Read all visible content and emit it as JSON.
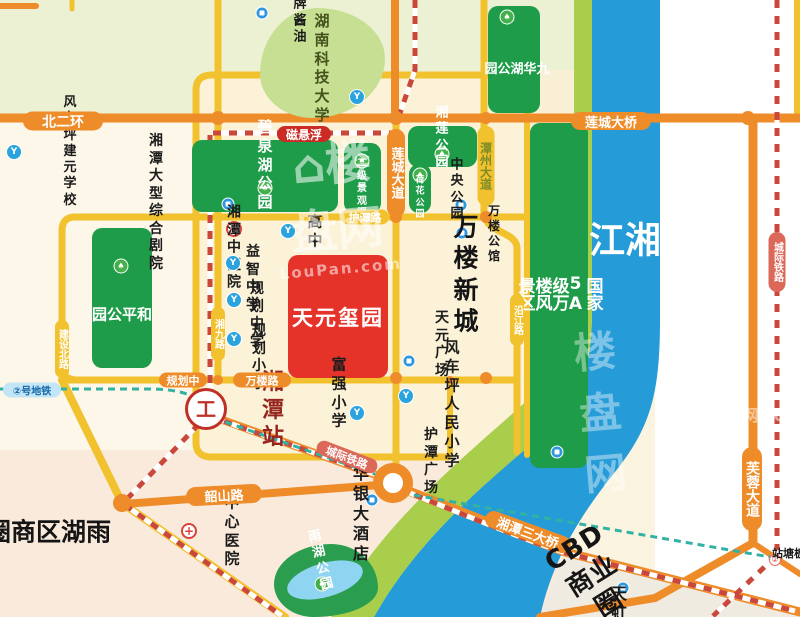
{
  "project": {
    "name_label": "天元玺园",
    "box": [
      288,
      255,
      100,
      123
    ],
    "color": "#E6332A"
  },
  "area_labels": [
    {
      "name": "wanlou-newtown-label",
      "text": "万楼新城",
      "c": [
        467,
        274
      ],
      "size": 25,
      "color": "#151515",
      "v": false,
      "rot": 0,
      "ls": 2
    },
    {
      "name": "yuhu-district-label",
      "text": "雨湖区商圈",
      "c": [
        47,
        532
      ],
      "size": 25,
      "color": "#151515",
      "v": true,
      "rot": 0,
      "ls": 2
    },
    {
      "name": "cbd-circle-label",
      "text": "CBD商业圈",
      "c": [
        592,
        576
      ],
      "size": 26,
      "color": "#151515",
      "v": false,
      "rot": -32,
      "ls": 1
    },
    {
      "name": "xiangjiang-river-label",
      "text": "湘江",
      "c": [
        621,
        241
      ],
      "size": 36,
      "color": "#FFFFFF",
      "v": true,
      "rot": 0,
      "ls": 4
    }
  ],
  "road_labels": [
    {
      "name": "beierhuan-road-label",
      "text": "北二环",
      "c": [
        63,
        121
      ],
      "w": 80,
      "h": 19,
      "bg": "#EE8C2A",
      "fg": "#FFFFFF",
      "size": 14,
      "v": false,
      "rot": 0
    },
    {
      "name": "liancheng-bridge-label",
      "text": "莲城大桥",
      "c": [
        611,
        121
      ],
      "w": 80,
      "h": 18,
      "bg": "#EE8C2A",
      "fg": "#FFFFFF",
      "size": 13,
      "v": false,
      "rot": 0
    },
    {
      "name": "maglev-label",
      "text": "磁悬浮",
      "c": [
        304,
        134
      ],
      "w": 54,
      "h": 16,
      "bg": "#CB2B24",
      "fg": "#FFFFFF",
      "size": 12,
      "v": false,
      "rot": 0
    },
    {
      "name": "liancheng-avenue-label",
      "text": "莲城大道",
      "c": [
        396,
        173
      ],
      "w": 18,
      "h": 88,
      "bg": "#EE8C2A",
      "fg": "#FFFFFF",
      "size": 13,
      "v": true,
      "rot": 0
    },
    {
      "name": "tanzhou-avenue-label",
      "text": "潭州大道",
      "c": [
        486,
        166
      ],
      "w": 17,
      "h": 80,
      "bg": "#F2C12E",
      "fg": "#7E8C28",
      "size": 12,
      "v": true,
      "rot": 0
    },
    {
      "name": "hutan-road-label",
      "text": "护潭路",
      "c": [
        365,
        217
      ],
      "w": 48,
      "h": 15,
      "bg": "#F2C12E",
      "fg": "#FFFFFF",
      "size": 11,
      "v": false,
      "rot": 0
    },
    {
      "name": "xiangjiu-road-label",
      "text": "湘九路",
      "c": [
        218,
        334
      ],
      "w": 14,
      "h": 54,
      "bg": "#F2C12E",
      "fg": "#FFFFFF",
      "size": 10,
      "v": true,
      "rot": 0
    },
    {
      "name": "jianshe-north-road-label",
      "text": "建设北路",
      "c": [
        62,
        349
      ],
      "w": 14,
      "h": 58,
      "bg": "#F2C12E",
      "fg": "#FFFFFF",
      "size": 10,
      "v": true,
      "rot": 0
    },
    {
      "name": "yanjiang-road-label",
      "text": "沿江路",
      "c": [
        517,
        320
      ],
      "w": 14,
      "h": 52,
      "bg": "#F2C12E",
      "fg": "#FFFFFF",
      "size": 10,
      "v": true,
      "rot": 0
    },
    {
      "name": "guihuazhong-road-label",
      "text": "规划中",
      "c": [
        183,
        380
      ],
      "w": 48,
      "h": 15,
      "bg": "#EE8C2A",
      "fg": "#FFFFFF",
      "size": 11,
      "v": false,
      "rot": 0
    },
    {
      "name": "wanlou-road-label",
      "text": "万楼路",
      "c": [
        262,
        380
      ],
      "w": 58,
      "h": 15,
      "bg": "#EE8C2A",
      "fg": "#FFFFFF",
      "size": 11,
      "v": false,
      "rot": 0
    },
    {
      "name": "shaoshan-road-label",
      "text": "韶山路",
      "c": [
        224,
        495
      ],
      "w": 76,
      "h": 19,
      "bg": "#EE8C2A",
      "fg": "#FFFFFF",
      "size": 13,
      "v": false,
      "rot": -3
    },
    {
      "name": "intercity-rail-sw-label",
      "text": "城际铁路",
      "c": [
        347,
        457
      ],
      "w": 64,
      "h": 15,
      "bg": "#DC685A",
      "fg": "#FFFFFF",
      "size": 11,
      "v": false,
      "rot": 21
    },
    {
      "name": "xiangtan-third-bridge-label",
      "text": "湘潭三大桥",
      "c": [
        528,
        532
      ],
      "w": 90,
      "h": 17,
      "bg": "#EE8C2A",
      "fg": "#FFFFFF",
      "size": 13,
      "v": false,
      "rot": 20
    },
    {
      "name": "furong-avenue-label",
      "text": "芙蓉大道",
      "c": [
        752,
        489
      ],
      "w": 20,
      "h": 84,
      "bg": "#EE8C2A",
      "fg": "#FFFFFF",
      "size": 14,
      "v": true,
      "rot": 0
    },
    {
      "name": "intercity-rail-east-label",
      "text": "城际铁路",
      "c": [
        777,
        262
      ],
      "w": 17,
      "h": 60,
      "bg": "#DC685A",
      "fg": "#FFFFFF",
      "size": 10,
      "v": true,
      "rot": 0
    },
    {
      "name": "metro-line2-label",
      "text": "②号地铁",
      "c": [
        32,
        390
      ],
      "w": 58,
      "h": 15,
      "bg": "#C3E6F7",
      "fg": "#1467A8",
      "size": 10,
      "v": false,
      "rot": 0
    }
  ],
  "parks": [
    {
      "name": "biquan-lake-park",
      "text": "碧泉湖公园",
      "box": [
        192,
        140,
        146,
        72
      ],
      "bg": "#1E9C49",
      "fg": "#FFFFFF",
      "label": [
        265,
        165
      ],
      "size": 15,
      "tree": [
        265,
        188
      ],
      "v": false
    },
    {
      "name": "erji-canal",
      "text": "二级\n景观渠",
      "box": [
        344,
        143,
        37,
        70
      ],
      "bg": "#1E9C49",
      "fg": "#FFFFFF",
      "label": [
        362,
        189
      ],
      "size": 10,
      "tree": [
        362,
        161
      ],
      "v": false
    },
    {
      "name": "xianglian-park",
      "text": "湘莲公园",
      "box": [
        408,
        126,
        69,
        41
      ],
      "bg": "#1E9C49",
      "fg": "#FFFFFF",
      "label": [
        442,
        138
      ],
      "size": 13,
      "tree": [
        442,
        154
      ],
      "v": false
    },
    {
      "name": "hehua-park",
      "text": "荷花\n公园",
      "box": [
        409,
        164,
        22,
        49
      ],
      "bg": "#1E9C49",
      "fg": "#FFFFFF",
      "label": [
        420,
        198
      ],
      "size": 9,
      "tree": [
        420,
        175
      ],
      "v": false
    },
    {
      "name": "jiuhua-lake-park",
      "text": "九华湖公园",
      "box": [
        488,
        6,
        52,
        107
      ],
      "bg": "#1E9C49",
      "fg": "#FFFFFF",
      "label": [
        515,
        68
      ],
      "size": 13,
      "tree": [
        507,
        17
      ],
      "v": true
    },
    {
      "name": "heping-park",
      "text": "和平公园",
      "box": [
        92,
        228,
        60,
        140
      ],
      "bg": "#1E9C49",
      "fg": "#FFFFFF",
      "label": [
        121,
        314
      ],
      "size": 15,
      "tree": [
        121,
        266
      ],
      "v": true
    },
    {
      "name": "wanlou-scenic-area",
      "text": "国家5A级万楼风景区",
      "box": [
        530,
        123,
        58,
        345
      ],
      "bg": "#1E9C49",
      "fg": "#FFFFFF",
      "label": [
        558,
        294
      ],
      "size": 17,
      "v": true,
      "place": [
        557,
        452
      ]
    },
    {
      "name": "hnust-university",
      "text": "湖南科技大学",
      "box": [
        260,
        8,
        125,
        110
      ],
      "bg": "#C6DF92",
      "fg": "#44531B",
      "label": [
        322,
        68
      ],
      "size": 15,
      "v": false,
      "blob": "46% 54% 58% 42% / 60% 46% 54% 40%",
      "school": [
        357,
        97
      ]
    },
    {
      "name": "yuhu-park",
      "text": "雨湖公园",
      "box": [
        274,
        544,
        104,
        73
      ],
      "bg": "#2A9D4E",
      "fg": "#FFFFFF",
      "label": [
        321,
        561
      ],
      "size": 13,
      "v": false,
      "rot": -14,
      "blob": "55% 45% 62% 38% / 55% 60% 40% 45%",
      "tree": [
        322,
        584
      ],
      "pond": [
        286,
        563,
        78,
        34,
        -16
      ]
    }
  ],
  "pois": [
    {
      "name": "longpai-sauce",
      "icon": "place",
      "ipos": [
        262,
        13
      ],
      "text": "龙牌酱油",
      "tpos": [
        300,
        13
      ],
      "size": 13
    },
    {
      "name": "fengcheping-jianyuan-school",
      "icon": "school",
      "ipos": [
        14,
        152
      ],
      "text": "风车坪建元学校",
      "tpos": [
        70,
        152
      ],
      "size": 13
    },
    {
      "name": "grand-theater",
      "icon": "place",
      "ipos": [
        228,
        204
      ],
      "text": "湘潭大型综合剧院",
      "tpos": [
        156,
        203
      ],
      "size": 14
    },
    {
      "name": "gaozhong-school",
      "icon": "school",
      "ipos": [
        288,
        231
      ],
      "text": "高中",
      "tpos": [
        315,
        231
      ],
      "size": 15
    },
    {
      "name": "tcm-hospital",
      "icon": "hospital",
      "ipos": [
        234,
        229
      ],
      "text": "湘潭中医院",
      "tpos": [
        234,
        248
      ],
      "size": 14
    },
    {
      "name": "yizhi-middle-school",
      "icon": "school",
      "ipos": [
        233,
        263
      ],
      "text": "益智中学",
      "tpos": [
        253,
        279
      ],
      "size": 14
    },
    {
      "name": "guihua-middle-school",
      "icon": "school",
      "ipos": [
        234,
        300
      ],
      "text": "规划中学",
      "tpos": [
        257,
        316
      ],
      "size": 14
    },
    {
      "name": "guihua-primary-school",
      "icon": "school",
      "ipos": [
        234,
        339
      ],
      "text": "规划小学",
      "tpos": [
        259,
        358
      ],
      "size": 14
    },
    {
      "name": "central-park",
      "icon": "place",
      "ipos": [
        461,
        205
      ],
      "text": "中央公园",
      "tpos": [
        457,
        190
      ],
      "size": 13
    },
    {
      "name": "wanlou-mansion",
      "icon": "place",
      "ipos": [
        462,
        233
      ],
      "text": "万楼公馆",
      "tpos": [
        494,
        234
      ],
      "size": 12
    },
    {
      "name": "tianyuan-square",
      "icon": "place",
      "ipos": [
        409,
        361
      ],
      "text": "天元广场",
      "tpos": [
        442,
        345
      ],
      "size": 14
    },
    {
      "name": "fuqiang-primary-school",
      "icon": "school",
      "ipos": [
        357,
        413
      ],
      "text": "富强小学",
      "tpos": [
        339,
        393
      ],
      "size": 15
    },
    {
      "name": "fengcheping-renmin-school",
      "icon": "school",
      "ipos": [
        406,
        396
      ],
      "text": "风车坪\n人民小学",
      "tpos": [
        452,
        404
      ],
      "size": 15
    },
    {
      "name": "xiangtan-station",
      "icon": "rail",
      "ipos": [
        206,
        409
      ],
      "text": "湘潭站",
      "tpos": [
        273,
        410
      ],
      "size": 22,
      "color": "#97251F",
      "big": true
    },
    {
      "name": "hutan-square",
      "icon": "none",
      "ipos": [
        0,
        0
      ],
      "text": "护潭广场",
      "tpos": [
        431,
        462
      ],
      "size": 14
    },
    {
      "name": "center-hospital",
      "icon": "hospital",
      "ipos": [
        189,
        531
      ],
      "text": "中心医院",
      "tpos": [
        232,
        531
      ],
      "size": 15
    },
    {
      "name": "huayin-hotel",
      "icon": "place",
      "ipos": [
        372,
        500
      ],
      "text": "华银大酒店",
      "tpos": [
        361,
        514
      ],
      "size": 16
    },
    {
      "name": "tianhong",
      "icon": "place",
      "ipos": [
        623,
        588
      ],
      "text": "天虹",
      "tpos": [
        619,
        604
      ],
      "size": 16
    },
    {
      "name": "bantang-station",
      "icon": "metro",
      "ipos": [
        775,
        560
      ],
      "text": "板塘站",
      "tpos": [
        788,
        553
      ],
      "size": 11,
      "v": true
    }
  ],
  "junction_dots": [
    [
      218,
      118,
      7
    ],
    [
      396,
      118,
      7
    ],
    [
      486,
      118,
      6
    ],
    [
      748,
      118,
      7
    ],
    [
      396,
      217,
      6
    ],
    [
      486,
      217,
      6
    ],
    [
      218,
      380,
      5
    ],
    [
      396,
      378,
      6
    ],
    [
      486,
      378,
      6
    ],
    [
      450,
      380,
      4
    ],
    [
      122,
      503,
      9
    ]
  ],
  "watermarks": [
    {
      "name": "watermark-center",
      "text": "⌂楼盘网",
      "sub": "LouPan.com",
      "c": [
        335,
        203
      ],
      "size": 46,
      "sub_size": 15,
      "opacity": 0.55,
      "rot": -5
    },
    {
      "name": "watermark-right",
      "text": "楼盘网",
      "sub": "",
      "c": [
        600,
        410
      ],
      "size": 42,
      "sub_size": 12,
      "opacity": 0.4,
      "rot": -5
    },
    {
      "name": "watermark-corner",
      "text": "网.com",
      "sub": "",
      "c": [
        772,
        414
      ],
      "size": 16,
      "sub_size": 10,
      "opacity": 0.5,
      "rot": 0
    }
  ]
}
